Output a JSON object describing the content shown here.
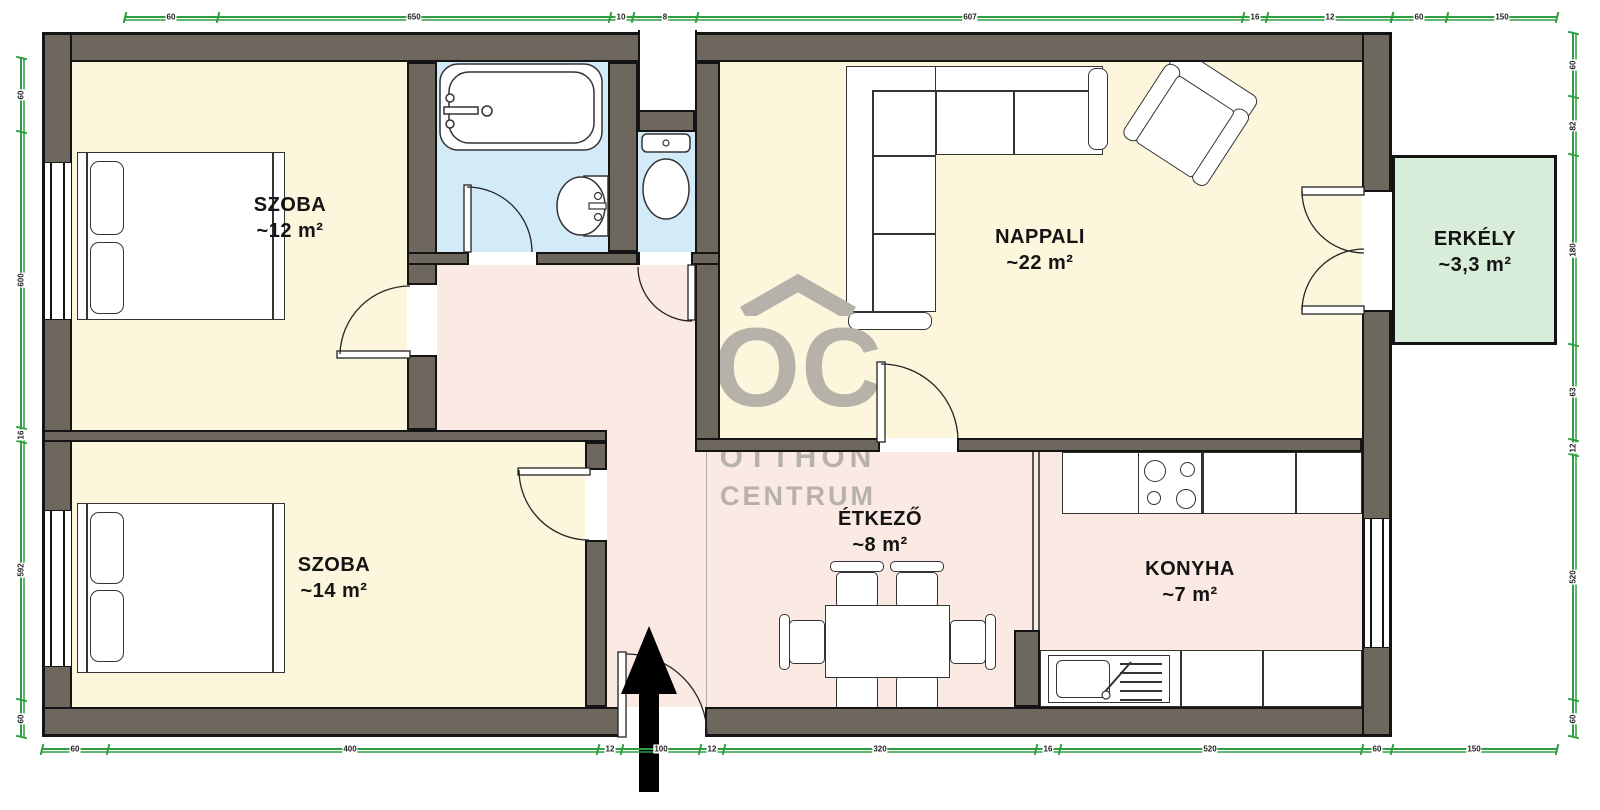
{
  "watermark": {
    "logo": "OC",
    "line1": "OTTHON",
    "line2": "CENTRUM"
  },
  "rooms": [
    {
      "id": "szoba-1",
      "name": "SZOBA",
      "area": "~12 m²"
    },
    {
      "id": "nappali",
      "name": "NAPPALI",
      "area": "~22 m²"
    },
    {
      "id": "erkely",
      "name": "ERKÉLY",
      "area": "~3,3 m²"
    },
    {
      "id": "szoba-2",
      "name": "SZOBA",
      "area": "~14 m²"
    },
    {
      "id": "etkezo",
      "name": "ÉTKEZŐ",
      "area": "~8 m²"
    },
    {
      "id": "konyha",
      "name": "KONYHA",
      "area": "~7 m²"
    }
  ],
  "fixtures": [
    "double-bed",
    "double-bed",
    "bathtub",
    "washbasin",
    "toilet",
    "corner-sofa",
    "armchair",
    "dining-table-6-chairs",
    "cooktop",
    "kitchen-sink",
    "entrance-arrow"
  ],
  "colors": {
    "wall": "#6e675e",
    "outline": "#141414",
    "room_floor": "#fbf6dc",
    "wet_floor": "#d3eaf8",
    "hall_floor": "#fbe9e4",
    "balcony_floor": "#d7edda",
    "dimension": "#2e9e40",
    "watermark": "#b6b2aa"
  },
  "dimensions": {
    "top": {
      "orient": "h",
      "pos": 16,
      "from": 125,
      "to": 1392,
      "ticks": [
        125,
        218,
        610,
        633,
        697,
        1243,
        1267,
        1392
      ],
      "labels": [
        {
          "t": "60",
          "p": 171
        },
        {
          "t": "650",
          "p": 414
        },
        {
          "t": "10",
          "p": 621
        },
        {
          "t": "8",
          "p": 665
        },
        {
          "t": "607",
          "p": 970
        },
        {
          "t": "16",
          "p": 1255
        },
        {
          "t": "12",
          "p": 1330
        }
      ]
    },
    "top_right": {
      "orient": "h",
      "pos": 16,
      "from": 1392,
      "to": 1557,
      "ticks": [
        1392,
        1447,
        1557
      ],
      "labels": [
        {
          "t": "60",
          "p": 1419
        },
        {
          "t": "150",
          "p": 1502
        }
      ]
    },
    "bottom": {
      "orient": "h",
      "pos": 748,
      "from": 42,
      "to": 1557,
      "ticks": [
        42,
        108,
        598,
        622,
        700,
        724,
        1036,
        1060,
        1362,
        1392,
        1557
      ],
      "labels": [
        {
          "t": "60",
          "p": 75
        },
        {
          "t": "400",
          "p": 350
        },
        {
          "t": "12",
          "p": 610
        },
        {
          "t": "100",
          "p": 661
        },
        {
          "t": "12",
          "p": 712
        },
        {
          "t": "320",
          "p": 880
        },
        {
          "t": "16",
          "p": 1048
        },
        {
          "t": "520",
          "p": 1210
        },
        {
          "t": "60",
          "p": 1377
        },
        {
          "t": "150",
          "p": 1474
        }
      ]
    },
    "left": {
      "orient": "v",
      "pos": 20,
      "from": 58,
      "to": 737,
      "ticks": [
        58,
        132,
        428,
        442,
        700,
        737
      ],
      "labels": [
        {
          "t": "60",
          "p": 95
        },
        {
          "t": "600",
          "p": 280
        },
        {
          "t": "16",
          "p": 435
        },
        {
          "t": "592",
          "p": 570
        },
        {
          "t": "60",
          "p": 719
        }
      ]
    },
    "right": {
      "orient": "v",
      "pos": 1572,
      "from": 33,
      "to": 737,
      "ticks": [
        33,
        97,
        155,
        345,
        440,
        455,
        700,
        737
      ],
      "labels": [
        {
          "t": "60",
          "p": 65
        },
        {
          "t": "82",
          "p": 126
        },
        {
          "t": "180",
          "p": 250
        },
        {
          "t": "63",
          "p": 392
        },
        {
          "t": "12",
          "p": 448
        },
        {
          "t": "520",
          "p": 577
        },
        {
          "t": "60",
          "p": 719
        }
      ]
    }
  }
}
